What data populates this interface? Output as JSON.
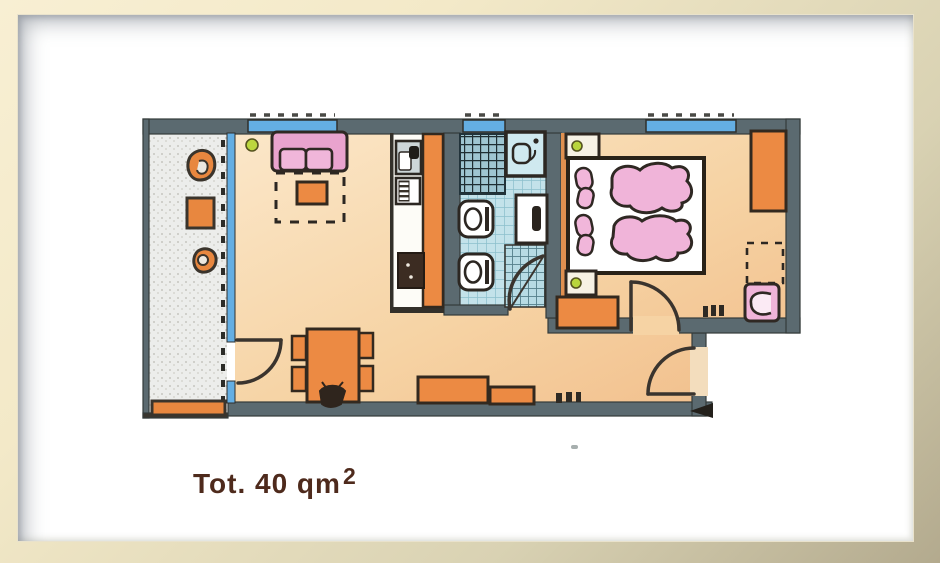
{
  "caption": {
    "text": "Tot. 40 qm",
    "superscript": "2"
  },
  "plan": {
    "kind": "apartment-floor-plan",
    "style": "hand-drawn-colored-pencil",
    "windows_count": 3,
    "doors": [
      "balcony-door",
      "bathroom-door",
      "bedroom-door",
      "entry-door"
    ],
    "rooms": [
      {
        "name": "balcony",
        "furniture": [
          "chair",
          "table",
          "chair",
          "planter-box"
        ]
      },
      {
        "name": "living-room",
        "furniture": [
          "sofa",
          "rug",
          "coffee-table",
          "dining-table",
          "chairs",
          "plant-bowl",
          "sideboard",
          "sideboard"
        ]
      },
      {
        "name": "kitchen",
        "furniture": [
          "sink",
          "stove",
          "refrigerator",
          "counter"
        ]
      },
      {
        "name": "bathroom",
        "furniture": [
          "shower",
          "washbasin",
          "toilet",
          "bidet",
          "sink-cabinet"
        ]
      },
      {
        "name": "bedroom",
        "furniture": [
          "double-bed",
          "pillows",
          "duvets",
          "nightstand",
          "nightstand",
          "wardrobe",
          "armchair",
          "dresser"
        ]
      }
    ],
    "palette": {
      "frame_light": "#f8efd3",
      "frame_dark": "#b3aa8e",
      "wall": "#5b6a70",
      "outline": "#33302a",
      "floor_living": "#f5d2a3",
      "floor_balcony": "#ecedeb",
      "floor_kitchen": "#fdfcf7",
      "floor_bath": "#c3e2ea",
      "window_blue": "#64aee3",
      "furniture_orange": "#ec8a43",
      "furniture_pink": "#eeaed6",
      "accent_green": "#bcd63e",
      "caption_brown": "#4e2a1c"
    }
  }
}
